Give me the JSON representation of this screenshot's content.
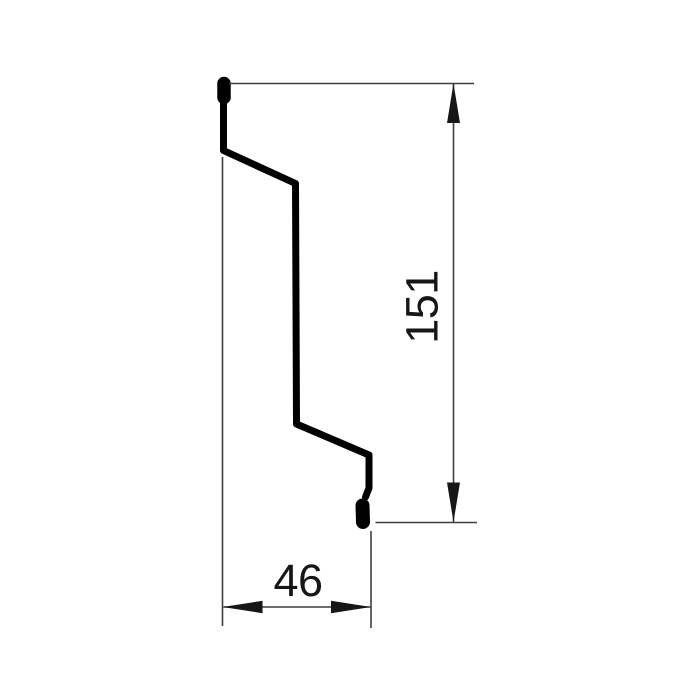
{
  "drawing": {
    "kind": "technical-profile-cross-section",
    "background": "#ffffff",
    "colors": {
      "profile": "#000000",
      "dimension_lines": "#3f3f3f",
      "arrows": "#161616",
      "text": "#161616"
    },
    "dimensions": {
      "height": {
        "label": "151",
        "value": 151,
        "orientation": "vertical"
      },
      "width": {
        "label": "46",
        "value": 46,
        "orientation": "horizontal"
      }
    }
  }
}
